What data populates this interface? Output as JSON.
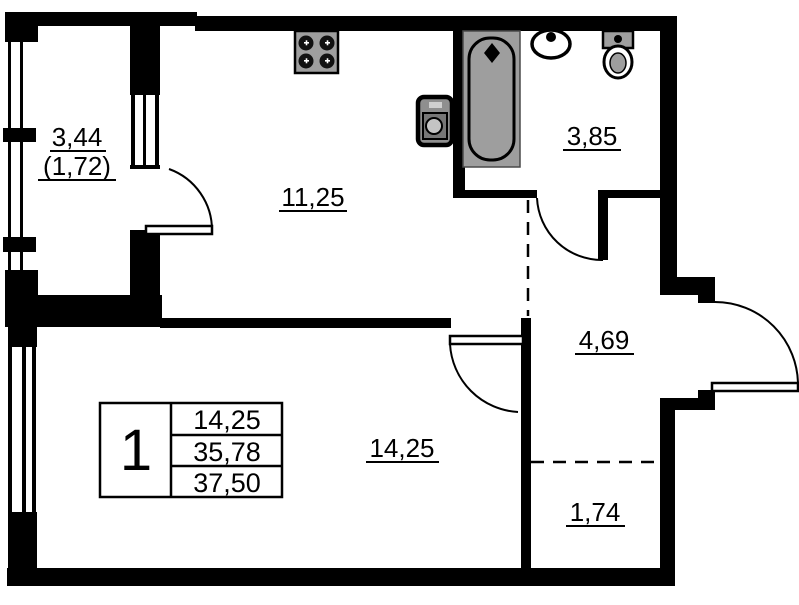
{
  "title": "Apartment floor plan",
  "rooms": {
    "balcony": {
      "area": "3,44",
      "secondary": "(1,72)"
    },
    "kitchen": {
      "area": "11,25"
    },
    "bathroom": {
      "area": "3,85"
    },
    "hall": {
      "area": "4,69"
    },
    "living": {
      "area": "14,25"
    },
    "closet": {
      "area": "1,74"
    }
  },
  "stamp": {
    "room_count": "1",
    "rows": [
      "14,25",
      "35,78",
      "37,50"
    ]
  },
  "fixtures": [
    "stove",
    "washing-machine",
    "bathtub",
    "sink",
    "toilet"
  ],
  "colors": {
    "walls": "#000000",
    "fixture_fill": "#9e9e9e",
    "background": "#ffffff"
  }
}
